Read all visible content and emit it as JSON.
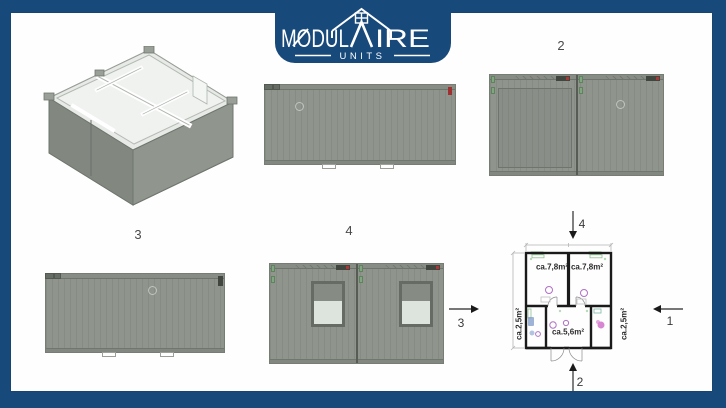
{
  "brand": {
    "wordmark_left": "MODUL",
    "wordmark_right": "IRE",
    "subtitle": "UNITS"
  },
  "view_labels": {
    "view2": "2",
    "view3": "3",
    "view4": "4"
  },
  "floor_plan": {
    "room_labels": [
      "ca.7,8m²",
      "ca.7,8m²",
      "ca.5,6m²",
      "ca.2,5m²",
      "ca.2,5m²"
    ],
    "arrows": {
      "top": "4",
      "bottom": "2",
      "right": "1",
      "left": "3"
    }
  },
  "colors": {
    "frame_blue": "#17497b",
    "container_gray": "#8f958d",
    "window_glass": "#dde3dd",
    "shutter_gray": "#868c84",
    "plan_wall": "#1a1a1a",
    "fixture_purple": "#b070c6",
    "fixture_green": "#8fc08f",
    "fixture_blue": "#86a0cc",
    "fixture_magenta": "#c95fc2"
  }
}
